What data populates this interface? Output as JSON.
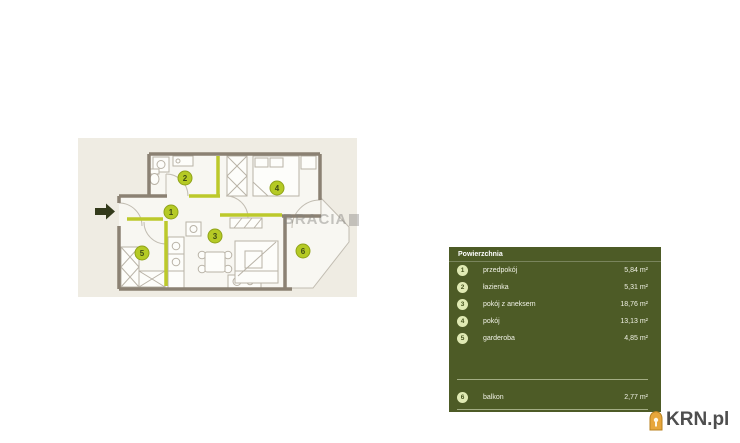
{
  "floor_plan": {
    "watermark": "BRACIA",
    "background_color": "#efece3",
    "wall_color": "#8b8173",
    "accent_wall_color": "#bcc92b",
    "room_badge_color": "#b5ca25",
    "entrance_arrow_color": "#333a1b"
  },
  "legend": {
    "header": "Powierzchnia",
    "panel_color": "#4d5b26",
    "badge_color": "#e0eab4",
    "text_color": "#f1f2e6",
    "rows": [
      {
        "num": "1",
        "name": "przedpokój",
        "area": "5,84 m²"
      },
      {
        "num": "2",
        "name": "łazienka",
        "area": "5,31 m²"
      },
      {
        "num": "3",
        "name": "pokój z aneksem",
        "area": "18,76 m²"
      },
      {
        "num": "4",
        "name": "pokój",
        "area": "13,13 m²"
      },
      {
        "num": "5",
        "name": "garderoba",
        "area": "4,85 m²"
      }
    ],
    "footer_rows": [
      {
        "num": "6",
        "name": "balkon",
        "area": "2,77 m²"
      }
    ]
  },
  "branding": {
    "logo_text": "KRN.pl",
    "logo_icon": "house-icon",
    "logo_icon_color": "#e7a63b",
    "logo_text_color": "#4e4e4e"
  }
}
